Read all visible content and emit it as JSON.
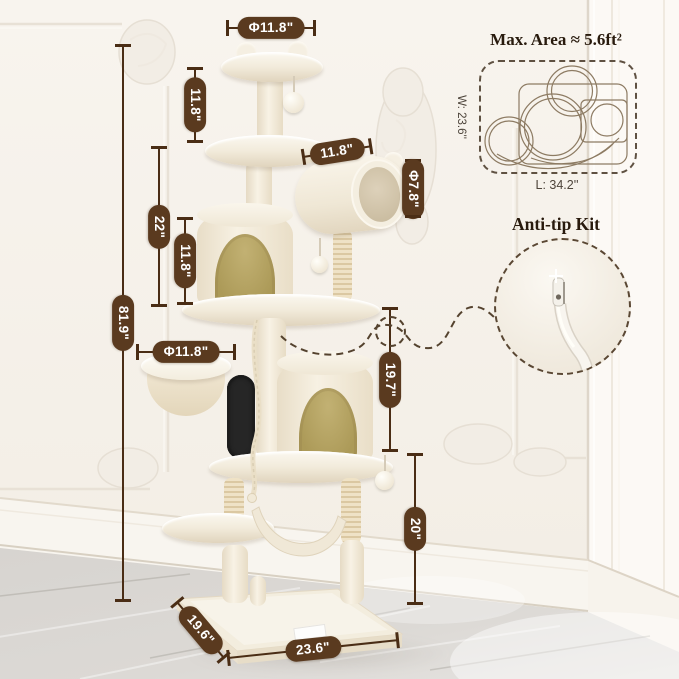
{
  "header": {
    "max_area_label": "Max. Area ≈ 5.6ft²",
    "footprint_width_label": "W: 23.6''",
    "footprint_length_label": "L: 34.2''",
    "anti_tip_label": "Anti-tip Kit"
  },
  "dimensions": {
    "top_perch_diameter": "Φ11.8\"",
    "top_section_height": "11.8\"",
    "upper_section_height": "22\"",
    "condo_section_height": "11.8\"",
    "total_height": "81.9\"",
    "tunnel_length": "11.8\"",
    "tunnel_diameter": "Φ7.8\"",
    "basket_diameter": "Φ11.8\"",
    "anchor_section_height": "19.7\"",
    "lower_section_height": "20\"",
    "base_depth": "19.6\"",
    "base_width": "23.6\""
  },
  "colors": {
    "dimension_line": "#4a2d15",
    "label_pill_bg": "#5a3a1f",
    "label_pill_text": "#ffffff",
    "heading_text": "#281a0d",
    "condo_door": "#ac9a58",
    "tree_cream": "#f2ebdc",
    "wall": "#f6f2ec",
    "floor": "#d9d6d2"
  }
}
